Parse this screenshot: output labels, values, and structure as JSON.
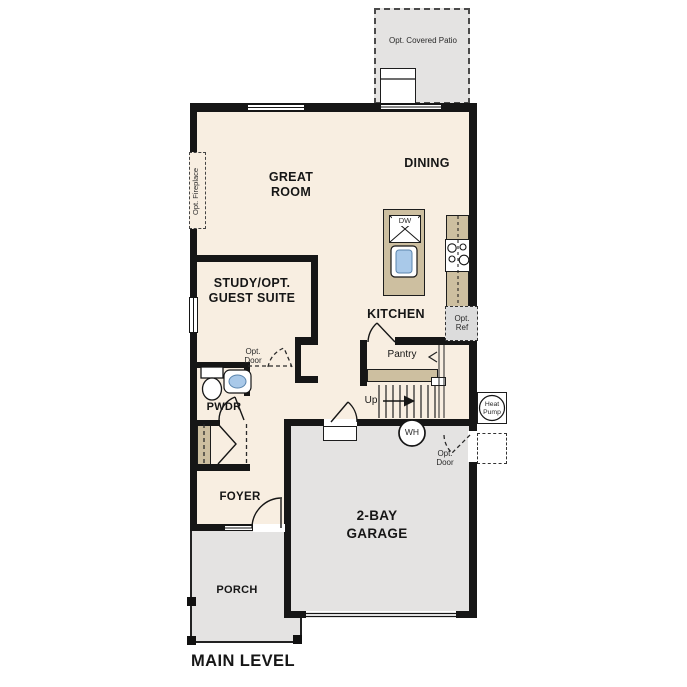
{
  "title": "MAIN LEVEL",
  "rooms": {
    "patio": "Opt. Covered Patio",
    "great_room": "GREAT ROOM",
    "dining": "DINING",
    "study": "STUDY/OPT. GUEST SUITE",
    "kitchen": "KITCHEN",
    "pantry": "Pantry",
    "pwdr": "PWDR",
    "foyer": "FOYER",
    "garage": "2-BAY GARAGE",
    "porch": "PORCH"
  },
  "labels": {
    "up": "Up",
    "wh": "WH",
    "dw": "DW",
    "heat_pump": "Heat Pump",
    "opt_ref": "Opt. Ref",
    "opt_fireplace": "Opt. Fireplace",
    "opt_door": "Opt. Door"
  },
  "colors": {
    "floor": "#f8eee1",
    "exterior_concrete": "#e4e3e2",
    "cabinetry": "#cdbfa0",
    "wall": "#161616",
    "sink_basin": "#a9c9e9"
  }
}
